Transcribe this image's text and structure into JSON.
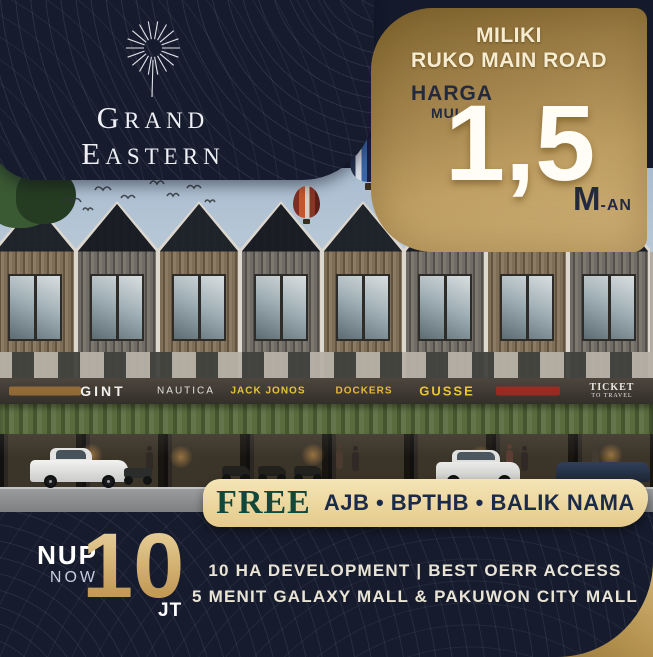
{
  "poster": {
    "brand": {
      "line1": "Grand",
      "line2": "Eastern"
    },
    "offer_panel": {
      "headline_line1": "MILIKI",
      "headline_line2": "RUKO MAIN ROAD",
      "price_label_top": "HARGA",
      "price_label_bottom": "MULAI",
      "price_value": "1,5",
      "price_unit": "M",
      "price_unit_suffix": "-AN"
    },
    "storefront_signs": {
      "gint": "GINT",
      "nautica": "NAUTICA",
      "jack_jonos": "JACK JONOS",
      "dockers": "DOCKERS",
      "gusse": "GUSSE",
      "ticket_line1": "TICKET",
      "ticket_line2": "TO TRAVEL"
    },
    "free_banner": {
      "free": "FREE",
      "items": "AJB • BPTHB • BALIK NAMA"
    },
    "nup": {
      "label": "NUP",
      "sublabel": "NOW",
      "value": "10",
      "unit": "JT"
    },
    "footer": {
      "line1": "10 HA DEVELOPMENT | BEST OERR ACCESS",
      "line2": "5 MENIT GALAXY MALL & PAKUWON CITY MALL"
    },
    "colors": {
      "navy": "#161c2e",
      "gold": "#c3a566",
      "cream": "#f3e8cd",
      "free_green": "#12473c",
      "banner_gold": "#ecd6a0",
      "sign_yellow": "#e8c435"
    }
  }
}
